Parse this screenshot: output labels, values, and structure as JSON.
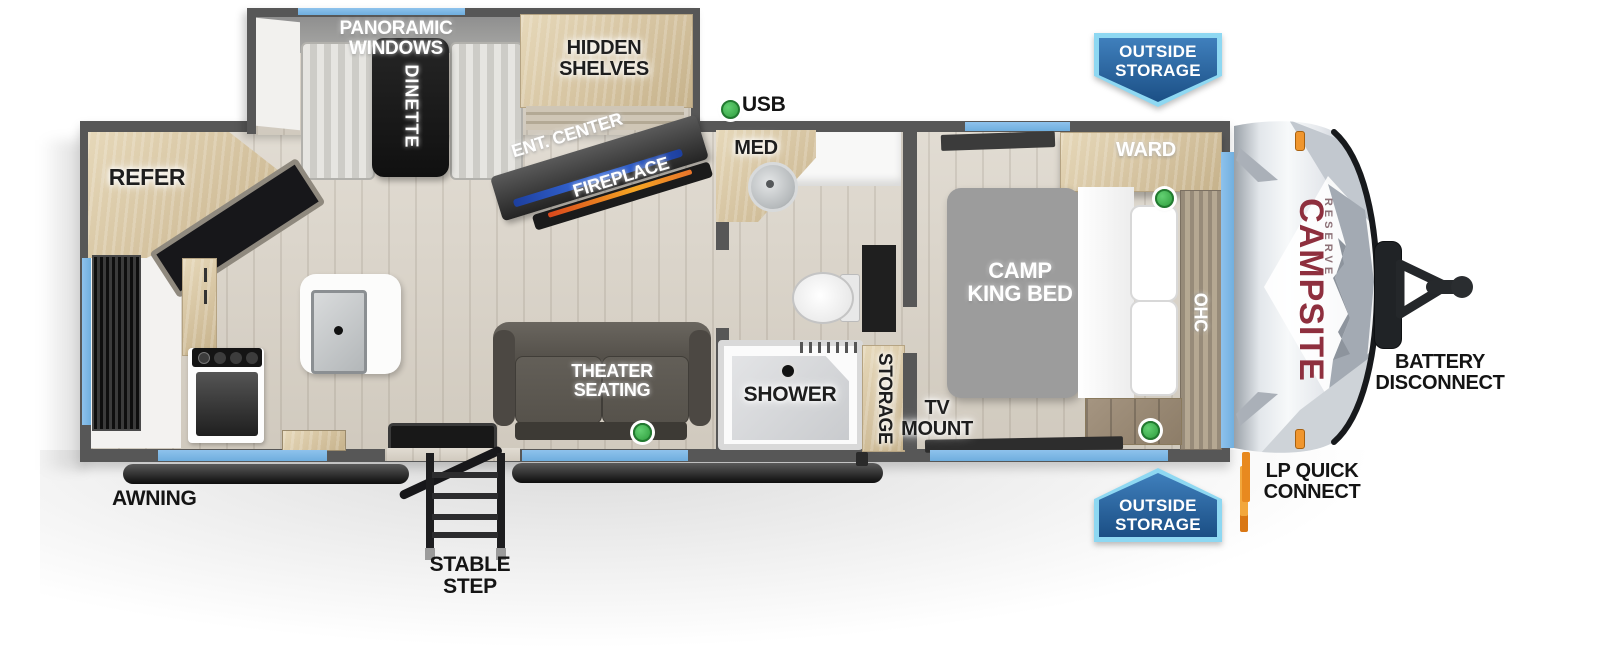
{
  "title": "Campsite Reserve travel trailer floor plan",
  "brand": {
    "name": "CAMPSITE",
    "series": "RESERVE"
  },
  "legend": {
    "usb": "USB",
    "usb_port_count": 3
  },
  "labels": {
    "panoramic_windows": "PANORAMIC WINDOWS",
    "dinette": "DINETTE",
    "hidden_shelves": "HIDDEN\nSHELVES",
    "ent_center": "ENT. CENTER",
    "fireplace": "FIREPLACE",
    "refer": "REFER",
    "med": "MED",
    "theater_seating": "THEATER\nSEATING",
    "shower": "SHOWER",
    "storage": "STORAGE",
    "tv_mount": "TV\nMOUNT",
    "camp_king_bed": "CAMP\nKING BED",
    "ward": "WARD",
    "ohc": "OHC",
    "outside_storage": "OUTSIDE\nSTORAGE",
    "battery_disconnect": "BATTERY\nDISCONNECT",
    "lp_quick_connect": "LP QUICK\nCONNECT",
    "awning": "AWNING",
    "stable_step": "STABLE STEP"
  },
  "colors": {
    "wall_gray": "#575757",
    "floor_wood": "#d9d2c6",
    "cabinet_wood": "#d5c3a0",
    "window_blue": "#79b5e6",
    "badge_blue": "#1b4f85",
    "badge_border": "#8ed8f2",
    "usb_green": "#3cb54a",
    "brand_red": "#8e2f3e",
    "mattress_gray": "#9c9c9c",
    "fireplace_orange": "#e8742a",
    "tv_strip_blue": "#2f62d8"
  }
}
